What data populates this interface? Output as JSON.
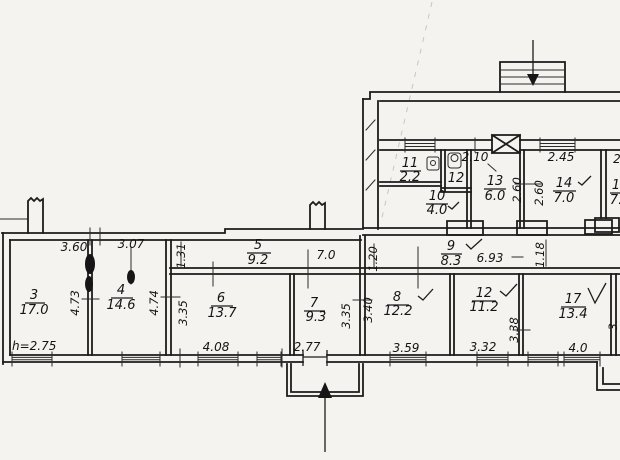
{
  "document": {
    "type": "scanned hand-drawn building floor plan",
    "height_note": "h=2.75"
  },
  "colors": {
    "paper": "#f4f3f0",
    "ink": "#1c1c1c"
  },
  "rooms": {
    "r3": {
      "num": "3",
      "area": "17.0"
    },
    "r4": {
      "num": "4",
      "area": "14.6"
    },
    "r5": {
      "num": "5",
      "area": "9.2"
    },
    "r6": {
      "num": "6",
      "area": "13.7"
    },
    "r7": {
      "num": "7",
      "area": "9.3"
    },
    "r8": {
      "num": "8",
      "area": "12.2"
    },
    "r9": {
      "num": "9",
      "area": "8.3"
    },
    "r10": {
      "num": "10",
      "area": "4.0"
    },
    "r11": {
      "num": "11",
      "area": "2.2"
    },
    "r12u": {
      "num": "12"
    },
    "r13": {
      "num": "13",
      "area": "6.0"
    },
    "r14": {
      "num": "14",
      "area": "7.0"
    },
    "r12": {
      "num": "12",
      "area": "11.2"
    },
    "r17": {
      "num": "17",
      "area": "13.4"
    },
    "redge": {
      "num": "1",
      "area": "7."
    }
  },
  "dims": {
    "w360": "3.60",
    "w307": "3.07",
    "v131": "1.31",
    "w70": "7.0",
    "v120": "1.20",
    "w693": "6.93",
    "v118": "1.18",
    "v473": "4.73",
    "v474": "4.74",
    "v335a": "3.35",
    "v335b": "3.35",
    "v340": "3.40",
    "w408": "4.08",
    "w277": "2.77",
    "w359": "3.59",
    "w332": "3.32",
    "v338": "3.38",
    "w40": "4.0",
    "w210": "2.10",
    "w245": "2.45",
    "v260a": "2.60",
    "v260b": "2.60",
    "edge_top": "2",
    "edge_v": "3."
  }
}
